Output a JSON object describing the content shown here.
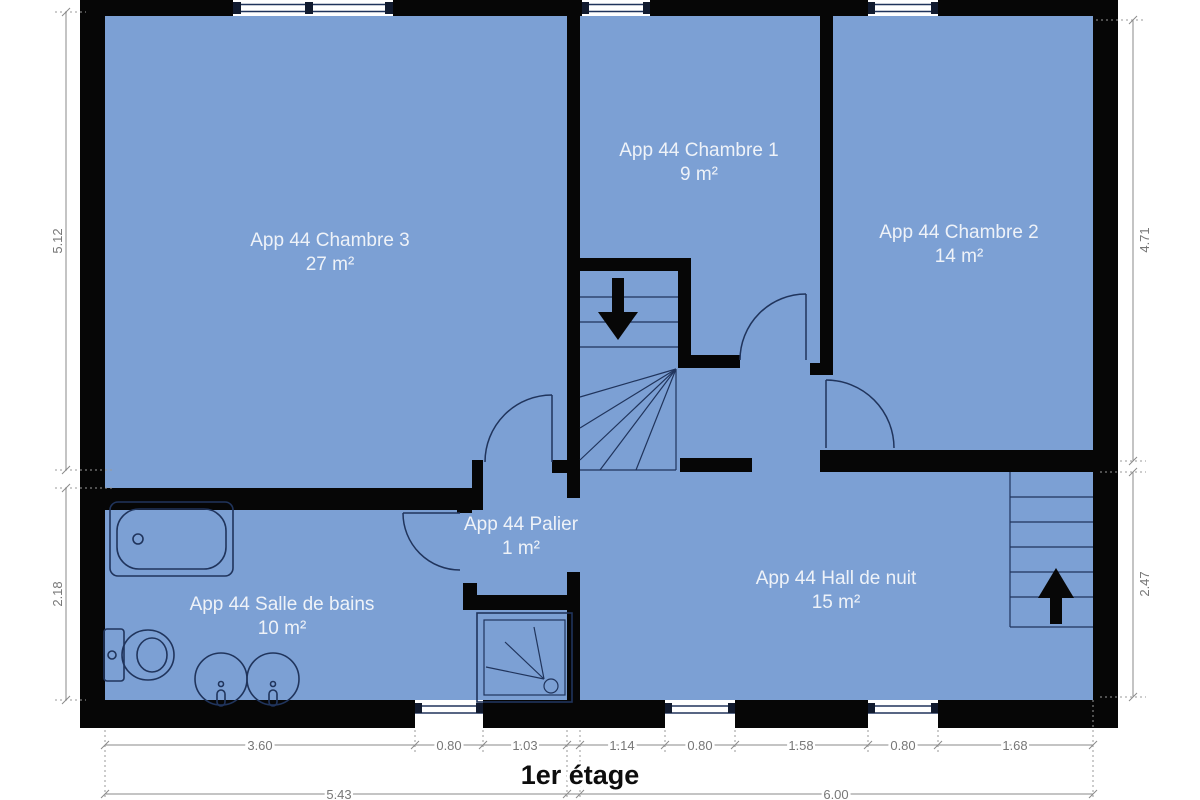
{
  "title": "1er étage",
  "colors": {
    "room_fill": "#7ca0d4",
    "wall": "#060606",
    "fixture_stroke": "#20345c",
    "dimension_gray": "#8a8a8a",
    "label_white": "#eef2f8"
  },
  "rooms": [
    {
      "name": "App 44 Chambre 3",
      "area": "27 m²"
    },
    {
      "name": "App 44 Chambre 1",
      "area": "9 m²"
    },
    {
      "name": "App 44 Chambre 2",
      "area": "14 m²"
    },
    {
      "name": "App 44 Palier",
      "area": "1 m²"
    },
    {
      "name": "App 44 Hall de nuit",
      "area": "15 m²"
    },
    {
      "name": "App 44 Salle de bains",
      "area": "10 m²"
    }
  ],
  "dims": {
    "left_top": "5.12",
    "left_bottom": "2.18",
    "right_top": "4.71",
    "right_bottom": "2.47",
    "bottom_row1": [
      "3.60",
      "0.80",
      "1.03",
      "1.14",
      "0.80",
      "1.58",
      "0.80",
      "1.68"
    ],
    "bottom_row2": [
      "5.43",
      "6.00"
    ]
  }
}
